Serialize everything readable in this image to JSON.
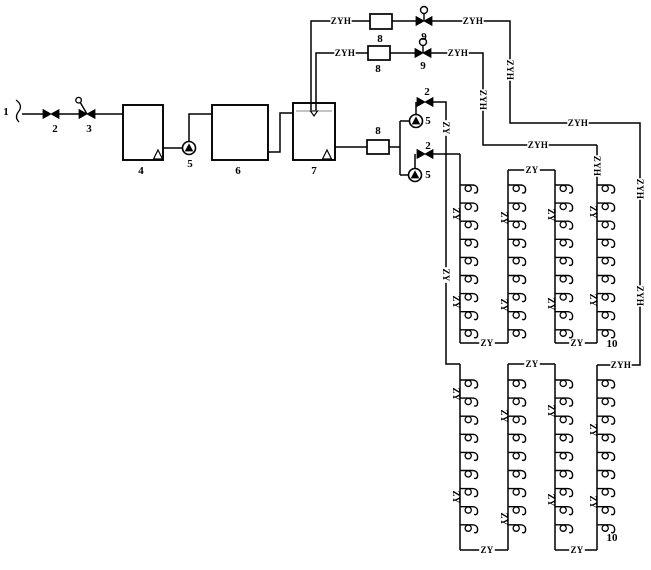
{
  "page": {
    "title": "Drinking water supply and circulation system schematic"
  },
  "canvas": {
    "width": 651,
    "height": 570
  },
  "colors": {
    "background": "#ffffff",
    "line": "#000000",
    "water_level": "#b0b0b0"
  },
  "legend": {
    "supply_pipe_code": "ZY",
    "return_pipe_code": "ZYH"
  },
  "equipment_numbers": [
    {
      "text": "1",
      "x": 6,
      "y": 115
    },
    {
      "text": "2",
      "x": 55,
      "y": 132
    },
    {
      "text": "3",
      "x": 89,
      "y": 132
    },
    {
      "text": "4",
      "x": 141,
      "y": 174
    },
    {
      "text": "5",
      "x": 190,
      "y": 167
    },
    {
      "text": "6",
      "x": 238,
      "y": 174
    },
    {
      "text": "7",
      "x": 314,
      "y": 174
    },
    {
      "text": "8",
      "x": 380,
      "y": 42
    },
    {
      "text": "9",
      "x": 424,
      "y": 40
    },
    {
      "text": "8",
      "x": 378,
      "y": 72
    },
    {
      "text": "9",
      "x": 423,
      "y": 69
    },
    {
      "text": "2",
      "x": 427,
      "y": 95
    },
    {
      "text": "5",
      "x": 428,
      "y": 124
    },
    {
      "text": "8",
      "x": 378,
      "y": 134
    },
    {
      "text": "2",
      "x": 428,
      "y": 149
    },
    {
      "text": "5",
      "x": 428,
      "y": 178
    },
    {
      "text": "10",
      "x": 612,
      "y": 347
    },
    {
      "text": "10",
      "x": 612,
      "y": 541
    }
  ],
  "pipe_labels": [
    {
      "text": "ZYH",
      "x": 341,
      "y": 21,
      "vertical": false,
      "on_line": true
    },
    {
      "text": "ZYH",
      "x": 473,
      "y": 21,
      "vertical": false,
      "on_line": true
    },
    {
      "text": "ZYH",
      "x": 345,
      "y": 53,
      "vertical": false,
      "on_line": true
    },
    {
      "text": "ZYH",
      "x": 458,
      "y": 53,
      "vertical": false,
      "on_line": true
    },
    {
      "text": "ZYH",
      "x": 578,
      "y": 123,
      "vertical": false,
      "on_line": true
    },
    {
      "text": "ZYH",
      "x": 538,
      "y": 145,
      "vertical": false,
      "on_line": true
    },
    {
      "text": "ZYH",
      "x": 621,
      "y": 365,
      "vertical": false,
      "on_line": true
    },
    {
      "text": "ZY",
      "x": 532,
      "y": 170,
      "vertical": false,
      "on_line": true
    },
    {
      "text": "ZY",
      "x": 487,
      "y": 343,
      "vertical": false,
      "on_line": true
    },
    {
      "text": "ZY",
      "x": 577,
      "y": 343,
      "vertical": false,
      "on_line": true
    },
    {
      "text": "ZY",
      "x": 532,
      "y": 364,
      "vertical": false,
      "on_line": true
    },
    {
      "text": "ZY",
      "x": 487,
      "y": 550,
      "vertical": false,
      "on_line": true
    },
    {
      "text": "ZY",
      "x": 577,
      "y": 550,
      "vertical": false,
      "on_line": true
    },
    {
      "text": "ZYH",
      "x": 510,
      "y": 70,
      "vertical": true,
      "on_line": true
    },
    {
      "text": "ZYH",
      "x": 483,
      "y": 100,
      "vertical": true,
      "on_line": true
    },
    {
      "text": "ZYH",
      "x": 597,
      "y": 166,
      "vertical": true,
      "on_line": true
    },
    {
      "text": "ZYH",
      "x": 640,
      "y": 189,
      "vertical": true,
      "on_line": true
    },
    {
      "text": "ZYH",
      "x": 640,
      "y": 296,
      "vertical": true,
      "on_line": true
    },
    {
      "text": "ZY",
      "x": 446,
      "y": 128,
      "vertical": true,
      "on_line": true
    },
    {
      "text": "ZY",
      "x": 446,
      "y": 275,
      "vertical": true,
      "on_line": true
    },
    {
      "text": "ZY",
      "x": 456,
      "y": 214,
      "vertical": true,
      "on_line": false
    },
    {
      "text": "ZY",
      "x": 456,
      "y": 302,
      "vertical": true,
      "on_line": false
    },
    {
      "text": "ZY",
      "x": 504,
      "y": 218,
      "vertical": true,
      "on_line": false
    },
    {
      "text": "ZY",
      "x": 504,
      "y": 305,
      "vertical": true,
      "on_line": false
    },
    {
      "text": "ZY",
      "x": 551,
      "y": 215,
      "vertical": true,
      "on_line": false
    },
    {
      "text": "ZY",
      "x": 551,
      "y": 304,
      "vertical": true,
      "on_line": false
    },
    {
      "text": "ZY",
      "x": 593,
      "y": 212,
      "vertical": true,
      "on_line": false
    },
    {
      "text": "ZY",
      "x": 593,
      "y": 300,
      "vertical": true,
      "on_line": false
    },
    {
      "text": "ZY",
      "x": 456,
      "y": 394,
      "vertical": true,
      "on_line": false
    },
    {
      "text": "ZY",
      "x": 456,
      "y": 497,
      "vertical": true,
      "on_line": false
    },
    {
      "text": "ZY",
      "x": 504,
      "y": 416,
      "vertical": true,
      "on_line": false
    },
    {
      "text": "ZY",
      "x": 504,
      "y": 519,
      "vertical": true,
      "on_line": false
    },
    {
      "text": "ZY",
      "x": 551,
      "y": 411,
      "vertical": true,
      "on_line": false
    },
    {
      "text": "ZY",
      "x": 551,
      "y": 500,
      "vertical": true,
      "on_line": false
    },
    {
      "text": "ZY",
      "x": 593,
      "y": 430,
      "vertical": true,
      "on_line": false
    },
    {
      "text": "ZY",
      "x": 593,
      "y": 502,
      "vertical": true,
      "on_line": false
    }
  ],
  "tanks": [
    {
      "name": "tank-4",
      "x": 123,
      "y": 105,
      "w": 40,
      "h": 55,
      "suction_triangle": {
        "x": 158,
        "y": 159
      }
    },
    {
      "name": "tank-6",
      "x": 212,
      "y": 105,
      "w": 56,
      "h": 55
    },
    {
      "name": "tank-7",
      "x": 293,
      "y": 103,
      "w": 42,
      "h": 57,
      "suction_triangle": {
        "x": 327,
        "y": 159
      },
      "water_level": {
        "y": 111,
        "marker_x": 314
      }
    }
  ],
  "pumps": [
    {
      "name": "transfer-pump-5",
      "x": 189,
      "y": 148
    },
    {
      "name": "supply-pump-5a",
      "x": 416,
      "y": 121
    },
    {
      "name": "supply-pump-5b",
      "x": 415,
      "y": 175
    }
  ],
  "valves": [
    {
      "name": "inlet-gate-valve-2",
      "type": "gate",
      "x": 51,
      "y": 114
    },
    {
      "name": "inlet-lever-valve-3",
      "type": "lever",
      "x": 87,
      "y": 114
    },
    {
      "name": "pump-a-discharge-valve-2",
      "type": "gate",
      "x": 425,
      "y": 102
    },
    {
      "name": "pump-b-discharge-valve-2",
      "type": "gate",
      "x": 425,
      "y": 154
    },
    {
      "name": "return-valve-9-1",
      "type": "actuated",
      "x": 424,
      "y": 21
    },
    {
      "name": "return-valve-9-2",
      "type": "actuated",
      "x": 423,
      "y": 53
    }
  ],
  "meters": [
    {
      "name": "flow-meter-8-1",
      "x": 370,
      "y": 14,
      "w": 22,
      "h": 15
    },
    {
      "name": "flow-meter-8-2",
      "x": 368,
      "y": 46,
      "w": 22,
      "h": 14
    },
    {
      "name": "flow-meter-8-3",
      "x": 367,
      "y": 140,
      "w": 22,
      "h": 14
    }
  ],
  "pipes": [
    [
      [
        22,
        114
      ],
      [
        43,
        114
      ]
    ],
    [
      [
        59,
        114
      ],
      [
        79,
        114
      ]
    ],
    [
      [
        95,
        114
      ],
      [
        123,
        114
      ]
    ],
    [
      [
        163,
        148
      ],
      [
        183,
        148
      ]
    ],
    [
      [
        189,
        142
      ],
      [
        189,
        114
      ],
      [
        212,
        114
      ]
    ],
    [
      [
        268,
        152
      ],
      [
        280,
        152
      ],
      [
        280,
        113
      ],
      [
        293,
        113
      ]
    ],
    [
      [
        335,
        147
      ],
      [
        367,
        147
      ]
    ],
    [
      [
        389,
        147
      ],
      [
        400,
        147
      ]
    ],
    [
      [
        400,
        121
      ],
      [
        400,
        175
      ]
    ],
    [
      [
        400,
        121
      ],
      [
        410,
        121
      ]
    ],
    [
      [
        416,
        115
      ],
      [
        416,
        102
      ]
    ],
    [
      [
        433,
        102
      ],
      [
        446,
        102
      ],
      [
        446,
        364
      ],
      [
        460,
        364
      ]
    ],
    [
      [
        400,
        175
      ],
      [
        409,
        175
      ]
    ],
    [
      [
        415,
        169
      ],
      [
        415,
        154
      ]
    ],
    [
      [
        433,
        154
      ],
      [
        460,
        154
      ]
    ],
    [
      [
        311,
        111
      ],
      [
        311,
        21
      ],
      [
        370,
        21
      ]
    ],
    [
      [
        392,
        21
      ],
      [
        416,
        21
      ]
    ],
    [
      [
        432,
        21
      ],
      [
        510,
        21
      ],
      [
        510,
        123
      ],
      [
        640,
        123
      ],
      [
        640,
        365
      ],
      [
        597,
        365
      ]
    ],
    [
      [
        316,
        111
      ],
      [
        316,
        53
      ],
      [
        368,
        53
      ]
    ],
    [
      [
        390,
        53
      ],
      [
        415,
        53
      ]
    ],
    [
      [
        431,
        53
      ],
      [
        483,
        53
      ],
      [
        483,
        145
      ],
      [
        597,
        145
      ]
    ]
  ],
  "blocks": [
    {
      "name": "upper-zone",
      "risers": [
        {
          "x": 460,
          "top": 154,
          "bottom": 343
        },
        {
          "x": 508,
          "top": 170,
          "bottom": 343
        },
        {
          "x": 555,
          "top": 170,
          "bottom": 343
        },
        {
          "x": 597,
          "top": 145,
          "bottom": 343
        }
      ],
      "links": [
        {
          "y": 170,
          "x1": 508,
          "x2": 555
        },
        {
          "y": 343,
          "x1": 460,
          "x2": 508
        },
        {
          "y": 343,
          "x1": 555,
          "x2": 597
        }
      ],
      "faucets": {
        "start": 185,
        "step": 18.1,
        "count": 9
      }
    },
    {
      "name": "lower-zone",
      "risers": [
        {
          "x": 460,
          "top": 364,
          "bottom": 550
        },
        {
          "x": 508,
          "top": 364,
          "bottom": 550
        },
        {
          "x": 555,
          "top": 364,
          "bottom": 550
        },
        {
          "x": 597,
          "top": 365,
          "bottom": 550
        }
      ],
      "links": [
        {
          "y": 364,
          "x1": 508,
          "x2": 555
        },
        {
          "y": 550,
          "x1": 460,
          "x2": 508
        },
        {
          "y": 550,
          "x1": 555,
          "x2": 597
        }
      ],
      "faucets": {
        "start": 380,
        "step": 18.1,
        "count": 9
      }
    }
  ],
  "break_symbol": {
    "x": 16,
    "y": 100
  }
}
